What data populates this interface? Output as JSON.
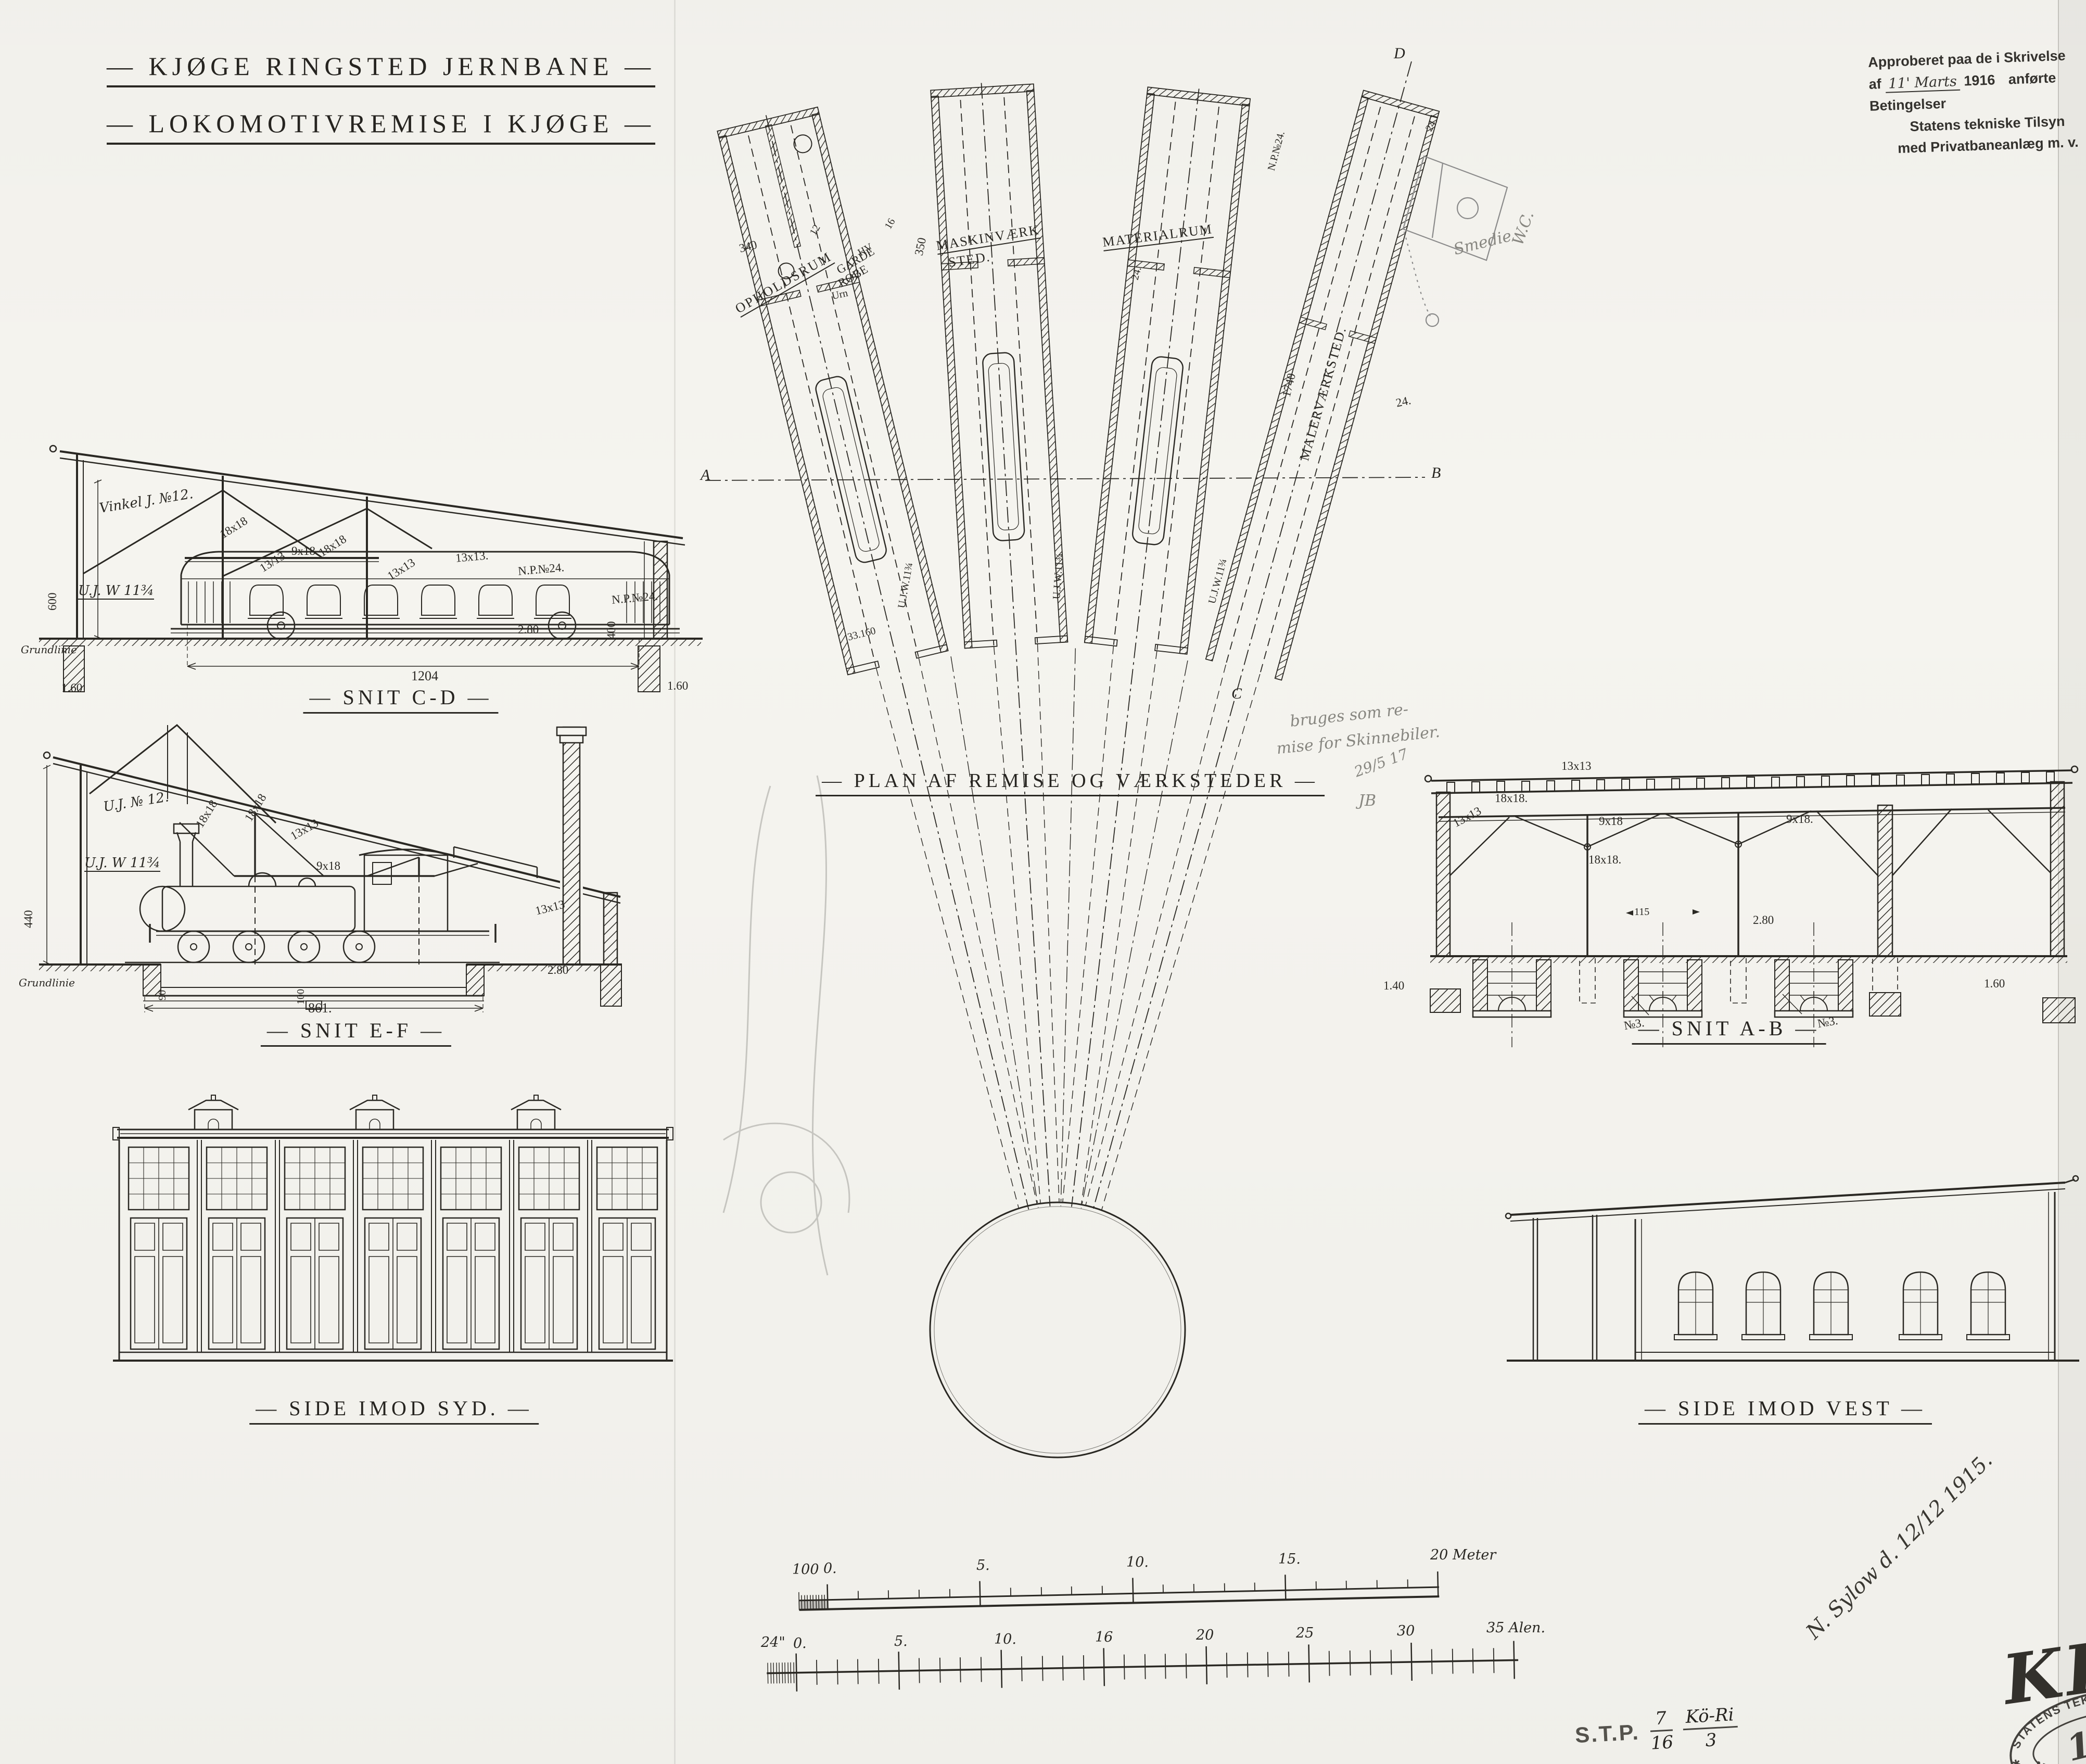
{
  "title": {
    "line1": "— KJØGE RINGSTED JERNBANE —",
    "line2": "— LOKOMOTIVREMISE I KJØGE —"
  },
  "approval": {
    "line1": "Approberet paa de i Skrivelse",
    "af": "af",
    "date": "11' Marts",
    "year": "1916",
    "rest": "anførte Betingelser",
    "line3": "Statens tekniske Tilsyn",
    "line4": "med Privatbaneanlæg m. v."
  },
  "plan": {
    "caption": "— PLAN AF REMISE OG VÆRKSTEDER —",
    "rooms": {
      "opholdsrum": "OPHOLDSRUM",
      "garde": "GARDE",
      "robe": "ROBE",
      "maskin1": "MASKINVÆRK",
      "maskin2": "STED.",
      "material": "MATERIALRUM",
      "maler": "MALERVÆRKSTED."
    },
    "dims": {
      "d340": "340",
      "d350": "350",
      "d1740": "1740",
      "d24a": "24.",
      "d24b": "24.",
      "d24c": "24.",
      "d12": "12",
      "d16": "16",
      "d33160": "33.160",
      "np24": "N.P.№24.",
      "uj1": "U.J.W.11¾",
      "uj2": "U.J.W.11¾",
      "uj3": "U.J.W.11¾"
    },
    "fixtures": {
      "hv": "HV",
      "urn": "Urn"
    },
    "markers": {
      "a": "A",
      "b": "B",
      "c": "C",
      "d": "D"
    },
    "pencil": {
      "smedie": "Smedie",
      "wc": "W.C.",
      "note1": "bruges som re-",
      "note2": "mise for Skinnebiler.",
      "date": "29/5 17",
      "init": "JB"
    }
  },
  "snit_cd": {
    "caption": "— SNIT C-D —",
    "vinkel": "Vinkel J. №12.",
    "ujw": "U.J. W 11¾",
    "d18a": "18x18",
    "d18b": "18x18",
    "d13a": "13/13",
    "d13b": "13x13",
    "d13c": "13x13.",
    "d9": "9x18",
    "np1": "N.P.№24.",
    "np2": "N.P.№24.",
    "v600": "600",
    "v400": "400",
    "d280": "2.80",
    "w1204": "1204",
    "l160": "1.60",
    "r160": "1.60",
    "ground": "Grundlinie"
  },
  "snit_ef": {
    "caption": "— SNIT E-F —",
    "uj12": "U.J. № 12.",
    "ujw": "U.J. W 11¾",
    "d18a": "18x18",
    "d18b": "18x18",
    "d13a": "13x13",
    "d13b": "13x13",
    "d9": "9x18",
    "v440": "440",
    "w861": "861.",
    "d280": "2.80",
    "p90": "90",
    "p100": "100",
    "ground": "Grundlinie"
  },
  "snit_ab": {
    "caption": "— SNIT A-B —",
    "d13a": "13x13",
    "d13b": "13x13",
    "d18a": "18x18.",
    "d18b": "18x18.",
    "d9a": "9x18",
    "d9b": "9x18.",
    "w115": "115",
    "d280": "2.80",
    "n3a": "№3.",
    "n3b": "№3.",
    "l140": "1.40",
    "r160": "1.60"
  },
  "side_syd": {
    "caption": "— SIDE IMOD SYD. —"
  },
  "side_vest": {
    "caption": "— SIDE IMOD VEST —"
  },
  "scales": {
    "meter": {
      "l100": "100",
      "l0": "0.",
      "l5": "5.",
      "l10": "10.",
      "l15": "15.",
      "l20": "20 Meter"
    },
    "alen": {
      "l24": "24\"",
      "l0": "0.",
      "l5": "5.",
      "l10": "10.",
      "l16": "16",
      "l20": "20",
      "l25": "25",
      "l30": "30",
      "l35": "35 Alen."
    }
  },
  "marginalia": {
    "signature": "N. Sylow d. 12/12 1915.",
    "krb": "KRB",
    "stp": "S.T.P.",
    "f1n": "7",
    "f1d": "16",
    "f2n": "Kö-Ri",
    "f2d": "3",
    "stamp_top": "STATENS TEKNISKE TILSYN",
    "stamp_bottom": "MED PRIVATBANEANLÆG",
    "stamp_no": "147",
    "stamp_star": "✱"
  }
}
